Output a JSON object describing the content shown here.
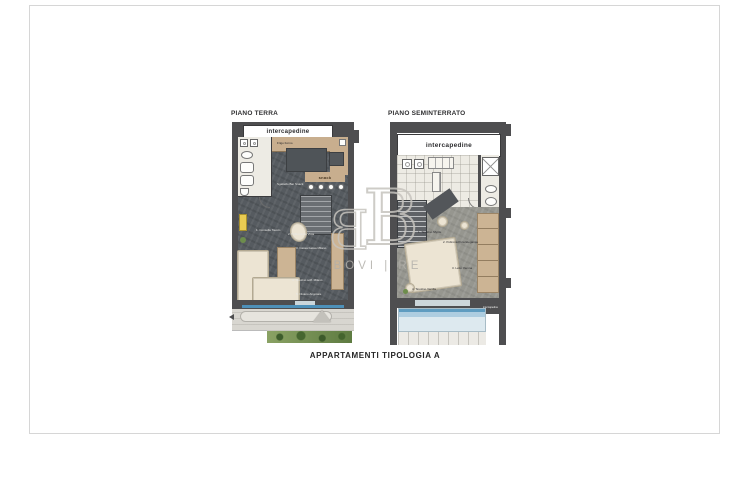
{
  "caption": "APPARTAMENTI TIPOLOGIA A",
  "watermark": {
    "monogram_left": "B",
    "monogram_right": "B",
    "wordmark": "BOVI | RE"
  },
  "piano_terra": {
    "title": "PIANO TERRA",
    "intercapedine_label": "intercapedine",
    "kitchen_note": "Frigo Forno",
    "snack_label": "snack",
    "furniture_labels": [
      "Sgabello Bar Snack",
      "1. Consolle Tavolo",
      "2. Poltrona La Vista",
      "3. Cassa bassa Milano",
      "4. Tavolino soff. Milano",
      "5. Divano Angolare"
    ]
  },
  "piano_seminterrato": {
    "title": "PIANO SEMINTERRATO",
    "intercapedine_label": "intercapedine",
    "intercapedine_small_label": "intercapedine",
    "furniture_labels": [
      "1. Tavolino Myrtle",
      "2. Poltrona Pura Elegance",
      "3. Letto Vienna",
      "4. Tavolino Vanilla"
    ]
  },
  "palette": {
    "wall": "#4e4e50",
    "dark_floor": "#565b60",
    "wood": "#c8ae8e",
    "cream": "#ece4d3",
    "water_blue": "#5f9cc0",
    "green": "#5e7b41",
    "watermark_gray": "#c6c3bd"
  }
}
